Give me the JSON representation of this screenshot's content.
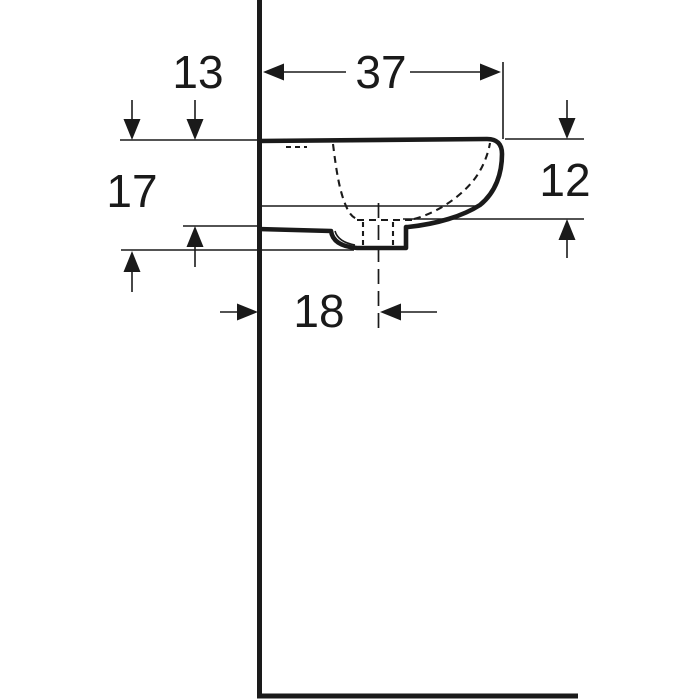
{
  "page": {
    "background_color": "#ffffff",
    "line_color": "#1a1a1a"
  },
  "drawing": {
    "subject": "wall-hung-washbasin-side-view",
    "dimensions": [
      {
        "id": "top-width",
        "label": "37"
      },
      {
        "id": "back-offset",
        "label": "13"
      },
      {
        "id": "overall-height",
        "label": "17"
      },
      {
        "id": "front-height",
        "label": "12"
      },
      {
        "id": "drain-offset",
        "label": "18"
      }
    ]
  }
}
